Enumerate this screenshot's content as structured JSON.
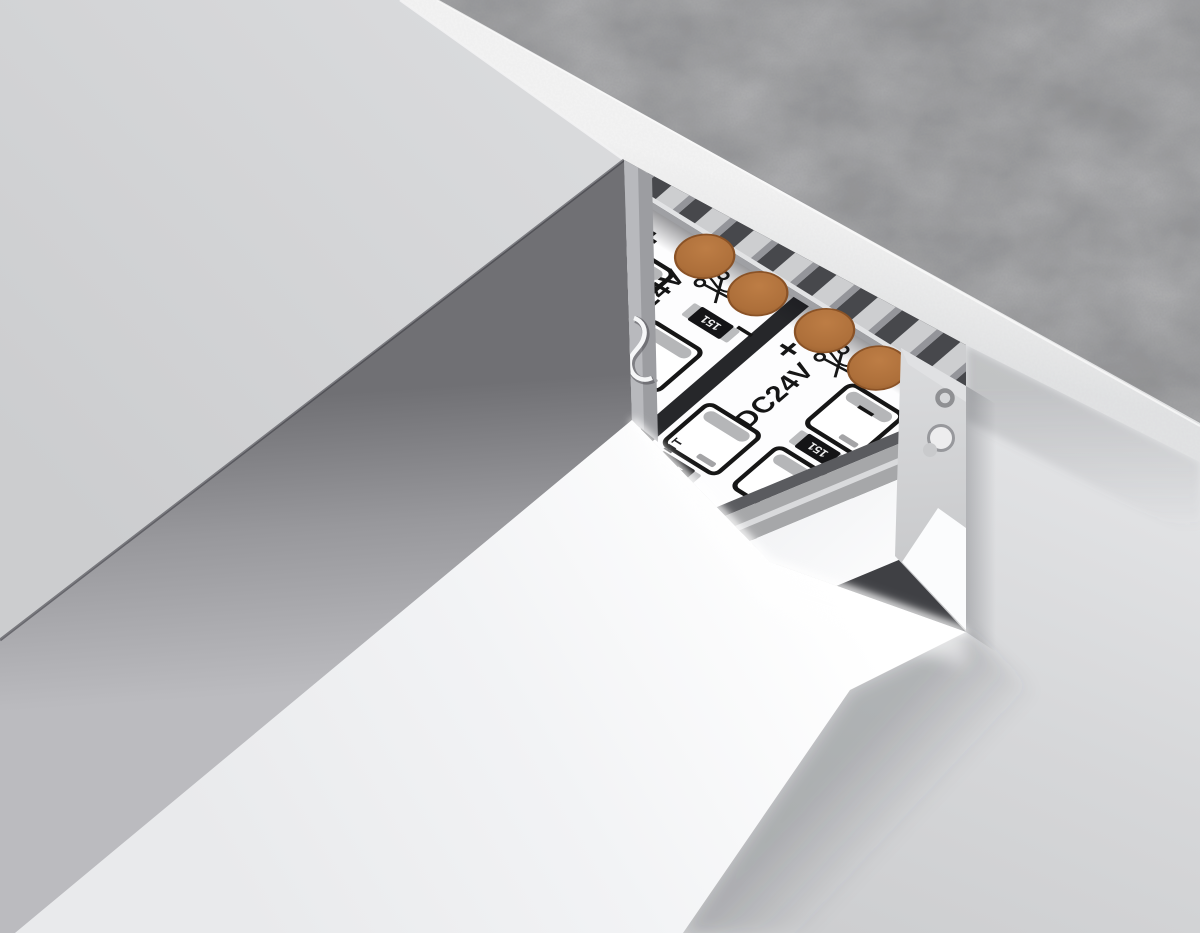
{
  "scene": {
    "type": "3d-product-render",
    "subject": "recessed-aluminum-led-profile-in-concrete-ceiling"
  },
  "led_strip": {
    "voltage_label": "DC24V",
    "plus_mark": "+",
    "minus_mark": "−",
    "resistor_code": "151",
    "brand": "AMBRELLA LIGHT"
  },
  "icons": {
    "scissors-icon": "✂",
    "brand-logo-icon": "◉",
    "plus-terminal-icon": "+",
    "minus-terminal-icon": "−"
  },
  "colors": {
    "copper_pad": "#ad6f3a",
    "pcb_white": "#ffffff",
    "aluminum_light": "#cdced0",
    "aluminum_dark": "#47484c",
    "concrete": "#8a8b8d",
    "plaster_edge": "#f1f1f1",
    "ceiling": "#d9dadc",
    "diffuser_face": "#f4f5f7",
    "recess_shadow": "#717175"
  }
}
